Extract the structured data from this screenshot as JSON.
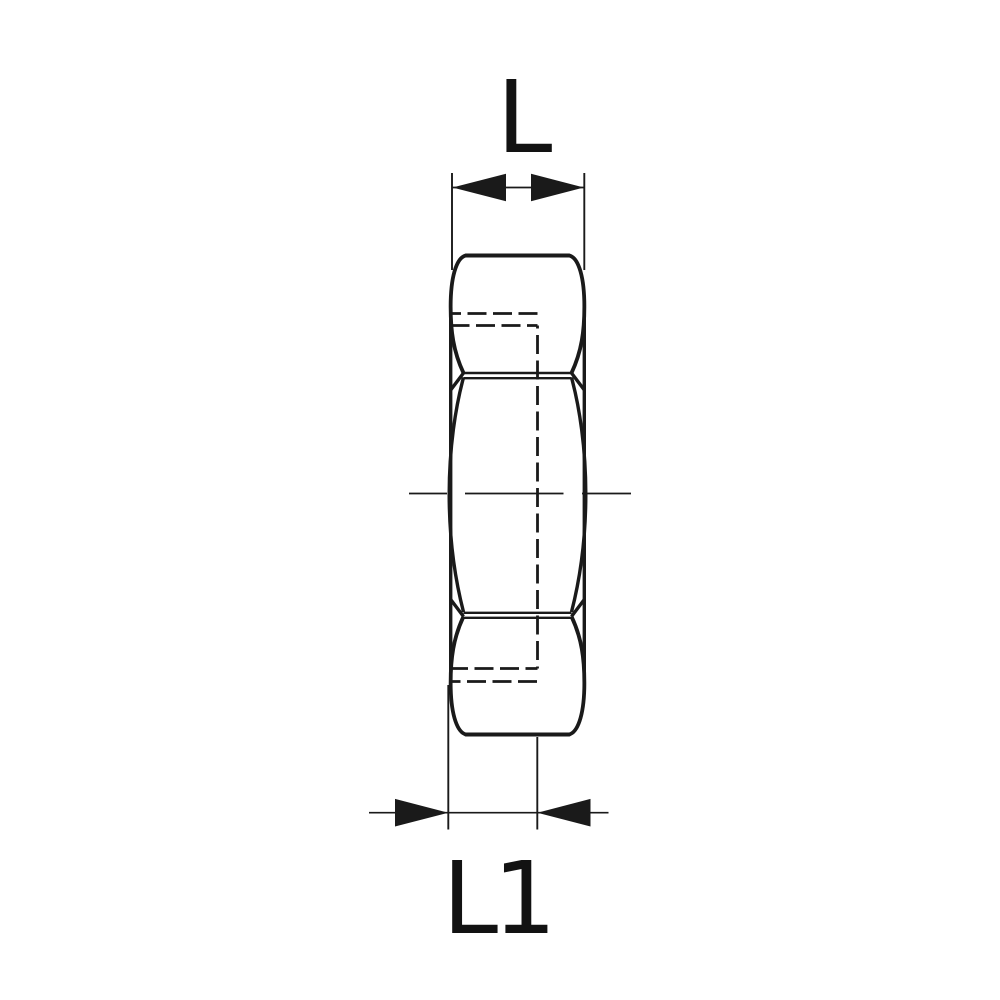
{
  "drawing": {
    "labels": {
      "length": "L",
      "length1": "L1"
    },
    "line_color": "#1a1a1a",
    "text_color": "#121212",
    "background_color": "#ffffff"
  }
}
